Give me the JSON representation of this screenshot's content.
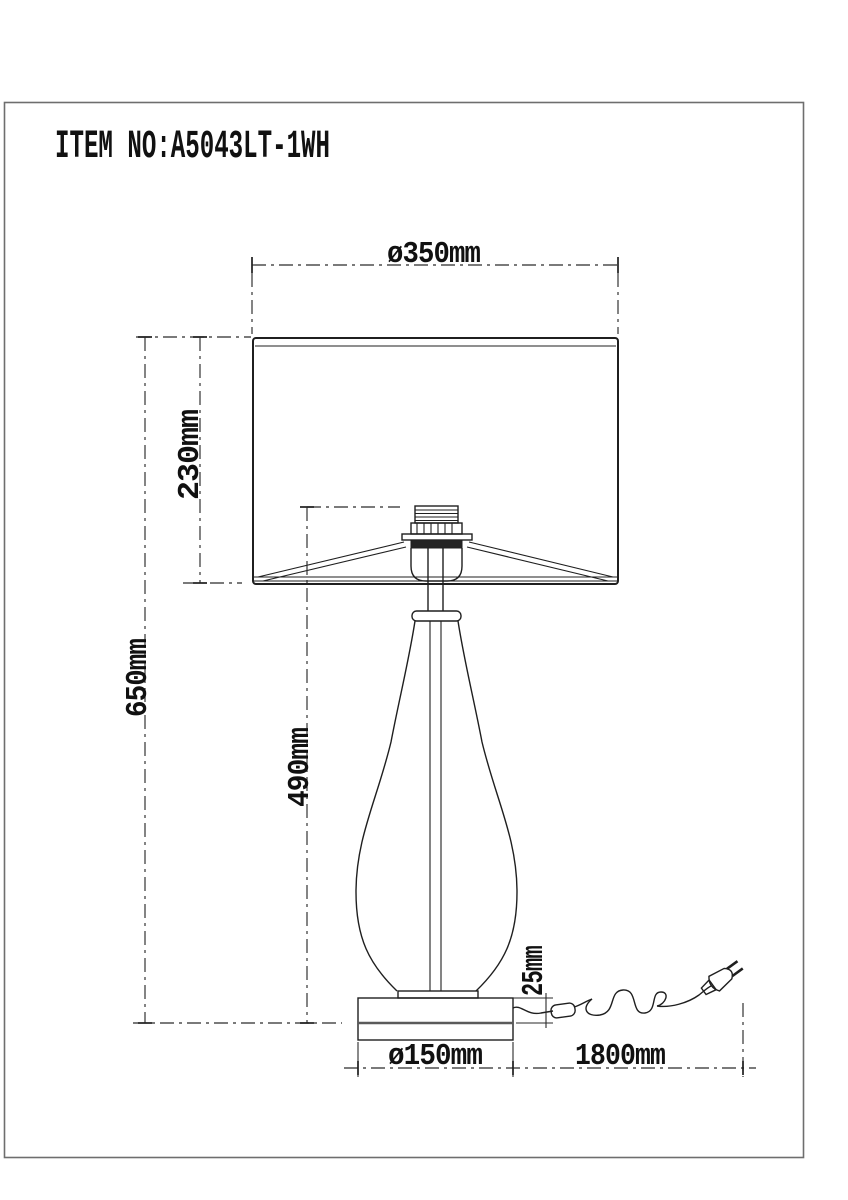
{
  "title": {
    "item_no": "ITEM NO:A5043LT-1WH"
  },
  "dimensions": {
    "shade_diameter": "ø350mm",
    "shade_height": "230mm",
    "total_height": "650mm",
    "body_height": "490mm",
    "base_top_offset": "25mm",
    "base_diameter": "ø150mm",
    "cord_length": "1800mm"
  },
  "colors": {
    "background": "#ffffff",
    "line": "#1f1f1f",
    "frame": "#6e6e6e"
  }
}
